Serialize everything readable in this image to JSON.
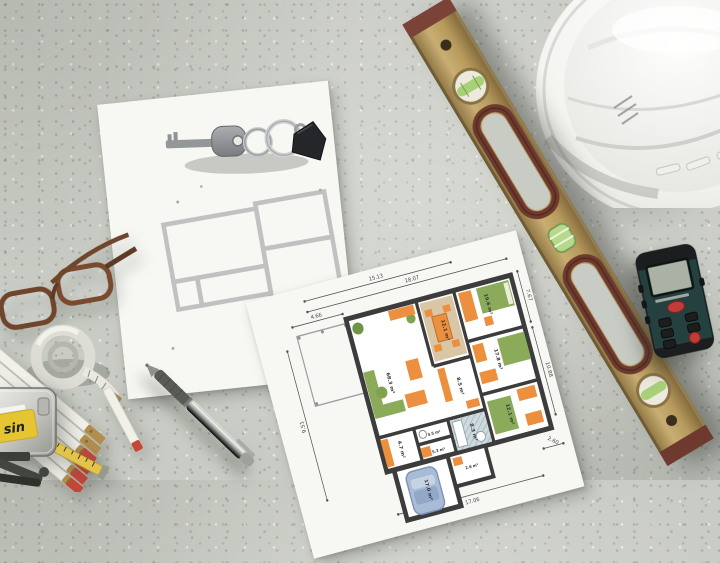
{
  "scene": {
    "surface": "concrete",
    "background_hex": "#c9ccc4"
  },
  "plan": {
    "dims": {
      "top_a": "15.13",
      "top_b": "18.07",
      "left_top": "4.66",
      "left_side": "9.51",
      "right_a": "7.67",
      "right_b": "10.88",
      "right_c": "9.61",
      "bottom_a": "17.06",
      "bottom_b": "2.60"
    },
    "rooms": {
      "living": "68.3 m²",
      "dining": "12.1 m²",
      "bedroom1": "19.6 m²",
      "bedroom2": "17.8 m²",
      "hall": "8.5 m²",
      "bedroom3": "12.1 m²",
      "bath": "8.3 m²",
      "wc": "3.5 m²",
      "utility": "5.3 m²",
      "storage": "4.7 m²",
      "entry": "2.6 m²",
      "garage": "17.0 m²"
    },
    "colors": {
      "wall": "#3c3c3c",
      "furniture_orange": "#ec8f3e",
      "furniture_green": "#8cab5a",
      "rug": "#d9c6a5",
      "car": "#a9bcd7",
      "bath": "#cfdade"
    }
  },
  "tools": {
    "tape_measure": {
      "label": "sin"
    },
    "level": {
      "body_hex": "#bb9f63",
      "wood_hex": "#6e3a2e",
      "vial_hex": "#a7d077"
    },
    "laser_meter": {
      "body_hex": "#25413f",
      "button_hex": "#c23b36"
    },
    "helmet": {
      "shell_hex": "#f4f4f1"
    }
  }
}
